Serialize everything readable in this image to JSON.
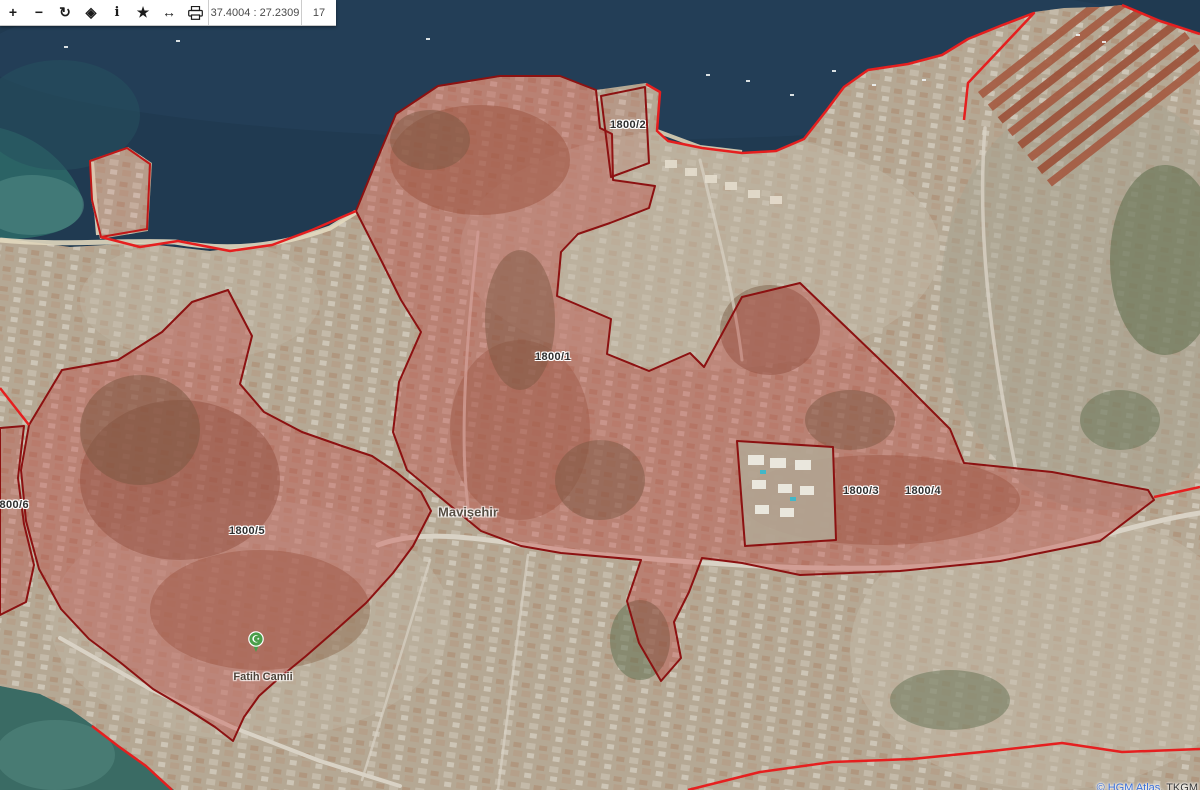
{
  "toolbar": {
    "buttons": [
      {
        "name": "zoom-in",
        "glyph": "+"
      },
      {
        "name": "zoom-out",
        "glyph": "−"
      },
      {
        "name": "refresh",
        "glyph": "↻"
      },
      {
        "name": "center",
        "glyph": "◈"
      },
      {
        "name": "info",
        "glyph": "i"
      },
      {
        "name": "favorites",
        "glyph": "★"
      },
      {
        "name": "measure",
        "glyph": "↔"
      },
      {
        "name": "print",
        "glyph": ""
      }
    ],
    "coordinates": "37.4004 : 27.2309",
    "zoom_level": "17"
  },
  "map": {
    "type": "satellite-cadastral-viewer",
    "parcels": [
      {
        "id": "1800/1",
        "x": 553,
        "y": 357
      },
      {
        "id": "1800/2",
        "x": 628,
        "y": 125
      },
      {
        "id": "1800/3",
        "x": 861,
        "y": 491
      },
      {
        "id": "1800/4",
        "x": 923,
        "y": 491
      },
      {
        "id": "1800/5",
        "x": 247,
        "y": 531
      },
      {
        "id": "1800/6",
        "x": 11,
        "y": 505
      }
    ],
    "places": [
      {
        "name": "Mavişehir",
        "x": 468,
        "y": 512
      },
      {
        "name": "Fatih Camii",
        "x": 263,
        "y": 677
      }
    ],
    "poi": {
      "type": "mosque",
      "x": 256,
      "y": 658
    },
    "attribution": {
      "link": "© HGM Atlas",
      "suffix": ", TKGM"
    },
    "colors": {
      "sea": "#203a51",
      "bay": "#2e6b68",
      "land": "#b5a894",
      "parcel_fill": "#c12e2e",
      "parcel_stroke": "#8c1111",
      "boundary_line": "#e51f1f"
    }
  }
}
